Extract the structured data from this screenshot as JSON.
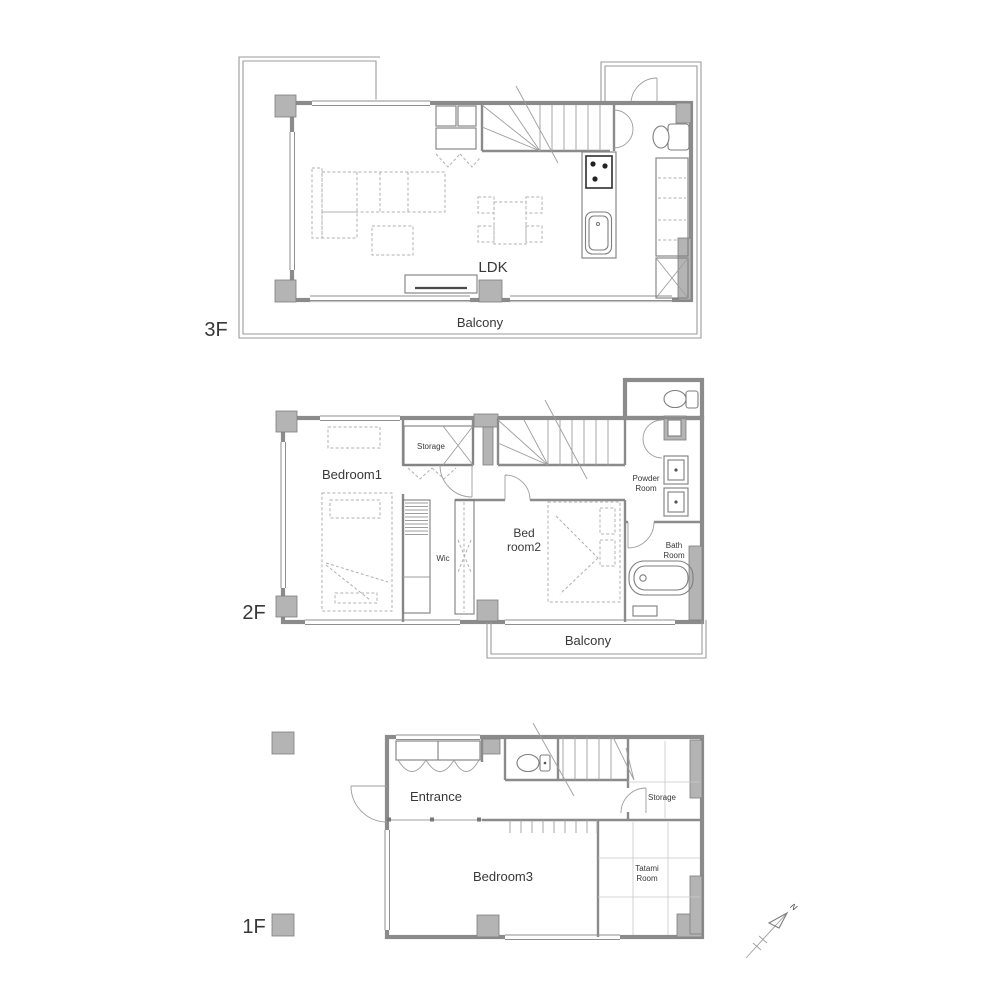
{
  "image": {
    "type": "architectural floor plan, 3 storey residence",
    "background": "#ffffff"
  },
  "palette": {
    "wall_gray": "#b4b4b4",
    "wall_line": "#8b8b8b",
    "fixture_line": "#7e7e7e",
    "thin_line": "#9e9e9e",
    "dash_line": "#b0b0b0",
    "text": "#383838",
    "stove_black": "#2e2e2e"
  },
  "f3": {
    "floor_label": "3F",
    "ldk": "LDK",
    "balcony": "Balcony"
  },
  "f2": {
    "floor_label": "2F",
    "bedroom1": "Bedroom1",
    "storage": "Storage",
    "wic": "Wic",
    "bedroom2_line1": "Bed",
    "bedroom2_line2": "room2",
    "powder_line1": "Powder",
    "powder_line2": "Room",
    "bath_line1": "Bath",
    "bath_line2": "Room",
    "balcony": "Balcony"
  },
  "f1": {
    "floor_label": "1F",
    "entrance": "Entrance",
    "bedroom3": "Bedroom3",
    "storage": "Storage",
    "tatami_line1": "Tatami",
    "tatami_line2": "Room"
  },
  "compass": {
    "north": "N"
  },
  "fixtures": {
    "f3": [
      "balcony-railing",
      "sofa",
      "coffee-table",
      "dining-set",
      "tv-board",
      "kitchen-island",
      "stove",
      "kitchen-sink",
      "tall-cabinet",
      "closet-cross",
      "staircase",
      "storage-closet",
      "toilet",
      "double-doors"
    ],
    "f2": [
      "single-bed",
      "double-bed",
      "walk-in-closet-shelves",
      "storage-closet",
      "staircase",
      "toilet",
      "twin-wash-basins",
      "bathtub",
      "balcony-railing",
      "door-arcs"
    ],
    "f1": [
      "shoe-cabinet",
      "entrance-door",
      "toilet",
      "staircase",
      "storage-shelves",
      "tatami-grid",
      "pillar-columns"
    ]
  }
}
